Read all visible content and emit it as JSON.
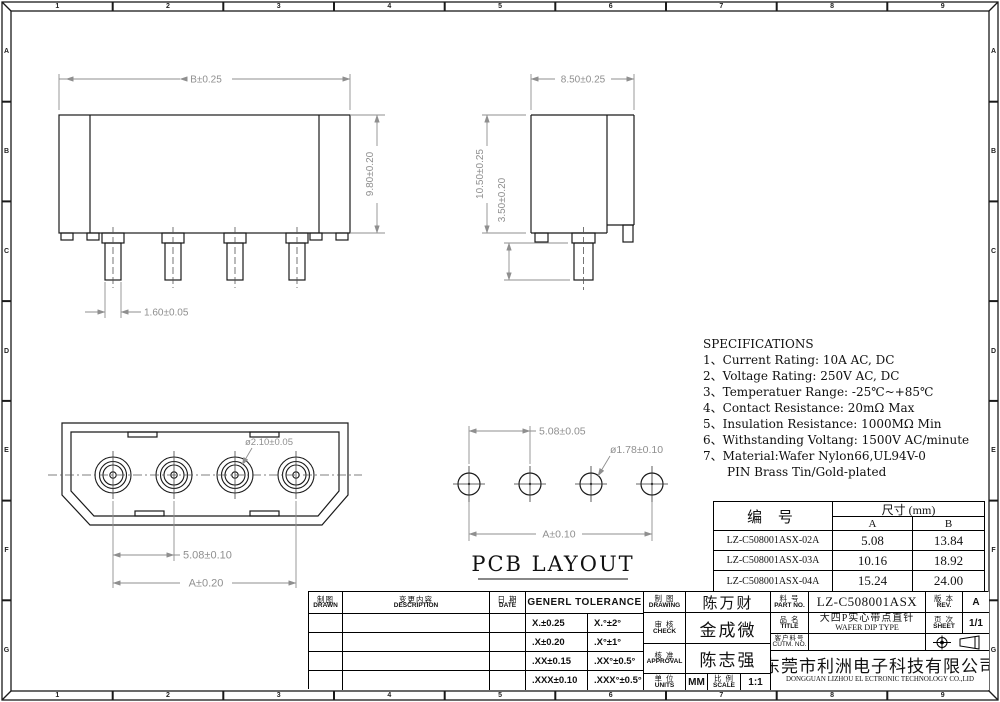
{
  "colors": {
    "outline": "#1a1a1a",
    "dimension": "#8f8f8f",
    "accent": "#000000"
  },
  "frame": {
    "columns": [
      "1",
      "2",
      "3",
      "4",
      "5",
      "6",
      "7",
      "8",
      "9"
    ],
    "rows": [
      "A",
      "B",
      "C",
      "D",
      "E",
      "F",
      "G"
    ]
  },
  "front_view": {
    "dim_width": "B±0.25",
    "dim_height": "9.80±0.20",
    "dim_pin_width": "1.60±0.05"
  },
  "side_view": {
    "dim_width": "8.50±0.25",
    "dim_height": "10.50±0.25",
    "dim_pin_length": "3.50±0.20"
  },
  "bottom_view": {
    "dim_hole": "ø2.10±0.05",
    "dim_pitch": "5.08±0.10",
    "dim_span": "A±0.20"
  },
  "pcb_view": {
    "title": "PCB LAYOUT",
    "dim_pitch": "5.08±0.05",
    "dim_hole": "ø1.78±0.10",
    "dim_span": "A±0.10"
  },
  "specifications": {
    "title": "SPECIFICATIONS",
    "lines": [
      "1、Current Rating: 10A AC, DC",
      "2、Voltage Rating: 250V AC, DC",
      "3、Temperatuer Range: -25℃~+85℃",
      "4、Contact Resistance: 20mΩ Max",
      "5、Insulation Resistance: 1000MΩ Min",
      "6、Withstanding Voltang: 1500V AC/minute",
      "7、Material:Wafer Nylon66,UL94V-0",
      "PIN Brass Tin/Gold-plated"
    ]
  },
  "parts_table": {
    "header_part": "编  号",
    "header_dim": "尺寸 (mm)",
    "header_a": "A",
    "header_b": "B",
    "rows": [
      {
        "part": "LZ-C508001ASX-02A",
        "a": "5.08",
        "b": "13.84"
      },
      {
        "part": "LZ-C508001ASX-03A",
        "a": "10.16",
        "b": "18.92"
      },
      {
        "part": "LZ-C508001ASX-04A",
        "a": "15.24",
        "b": "24.00"
      }
    ]
  },
  "title_block": {
    "drawn_cn": "制图",
    "drawn_en": "DRAWN",
    "description_cn": "变更内容",
    "description_en": "DESCRIPTION",
    "date_cn": "日 期",
    "date_en": "DATE",
    "tolerance_header": "GENERL TOLERANCE",
    "tolerances": [
      [
        "X.±0.25",
        "X.°±2°"
      ],
      [
        ".X±0.20",
        ".X°±1°"
      ],
      [
        ".XX±0.15",
        ".XX°±0.5°"
      ],
      [
        ".XXX±0.10",
        ".XXX°±0.5°"
      ]
    ],
    "drawing_cn": "制 图",
    "drawing_en": "DRAWING",
    "drawing_name": "陈万财",
    "check_cn": "审 核",
    "check_en": "CHECK",
    "check_name": "金成微",
    "approval_cn": "核 准",
    "approval_en": "APPROVAL",
    "approval_name": "陈志强",
    "units_cn": "单 位",
    "units_en": "UNITS",
    "units_value": "MM",
    "scale_cn": "比 例",
    "scale_en": "SCALE",
    "scale_value": "1:1",
    "part_no_cn": "料 号",
    "part_no_en": "PART NO.",
    "part_no_value": "LZ-C508001ASX",
    "title_cn": "品 名",
    "title_en": "TITLE",
    "title_value_cn": "大四P实心带点直针",
    "title_value_en": "WAFER DIP TYPE",
    "customer_cn": "客户料号",
    "customer_en": "CUTM. NO.",
    "customer_value": "",
    "rev_cn": "版 本",
    "rev_en": "REV.",
    "rev_value": "A",
    "sheet_cn": "页 次",
    "sheet_en": "SHEET",
    "sheet_value": "1/1",
    "company_cn": "东莞市利洲电子科技有限公司",
    "company_en": "DONGGUAN LIZHOU EL ECTRONIC TECHNOLOGY CO.,LID"
  }
}
